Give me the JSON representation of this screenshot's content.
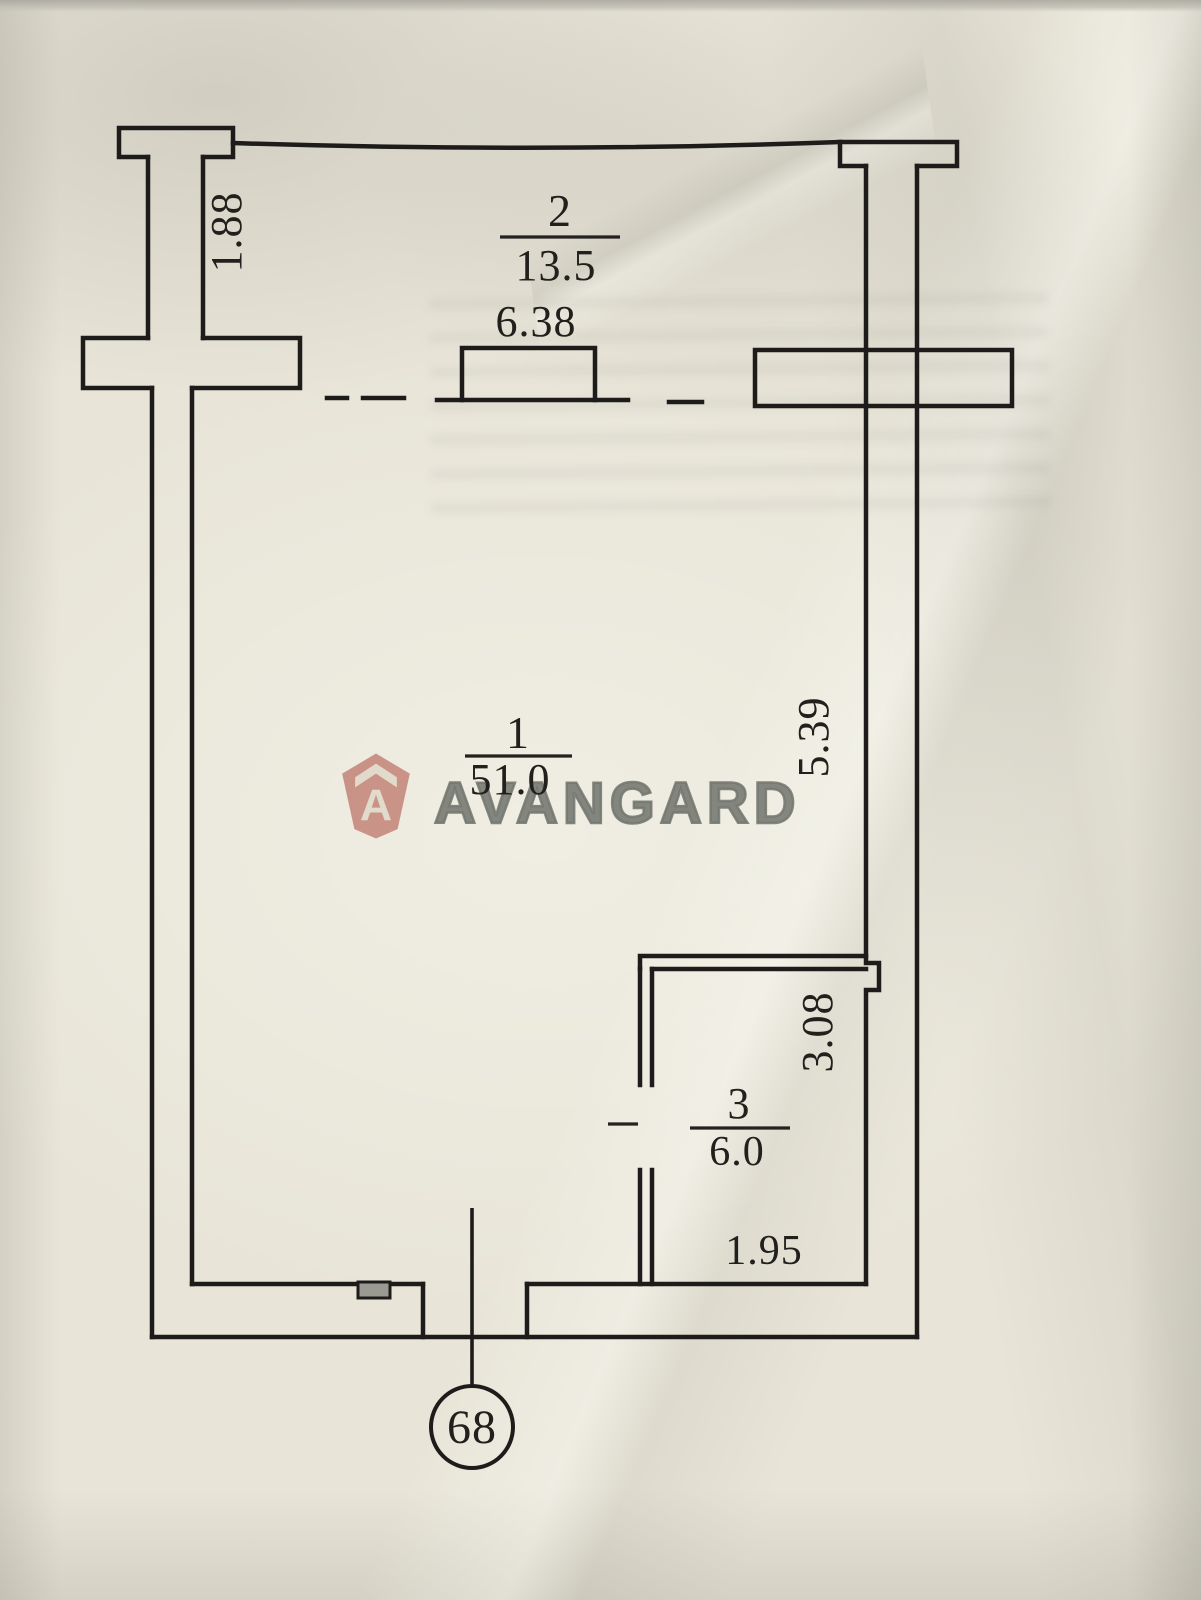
{
  "unit": {
    "number_in_circle": "68"
  },
  "rooms": [
    {
      "id": "2",
      "area": "13.5",
      "width": "6.38",
      "depth": "1.88"
    },
    {
      "id": "1",
      "area": "51.0",
      "right_side": "5.39"
    },
    {
      "id": "3",
      "area": "6.0",
      "height": "3.08",
      "width": "1.95"
    }
  ],
  "watermark": {
    "text": "AVANGARD",
    "icon": "house-a-badge",
    "icon_color": "#d08a84",
    "text_color": "#7c817e"
  },
  "colors": {
    "paper": "#e8e5d8",
    "ink": "#1d1c1a",
    "notch_fill": "#9a9a93"
  }
}
